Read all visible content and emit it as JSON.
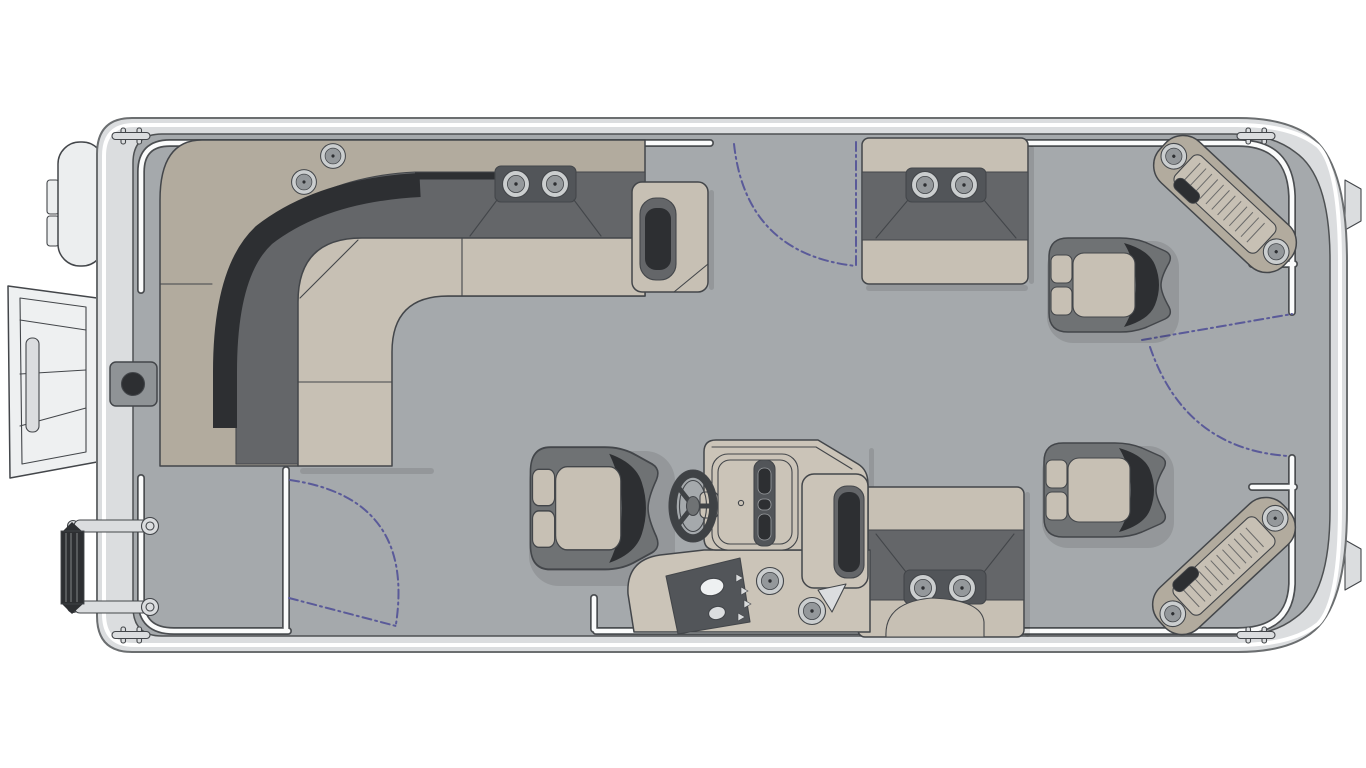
{
  "canvas": {
    "width": 1366,
    "height": 768,
    "background": "#ffffff"
  },
  "colors": {
    "line": "#43464a",
    "hull": "#dbdddf",
    "hull2": "#eceeef",
    "deck": "#a5a9ac",
    "raild": "#4b4e51",
    "railw": "#fafbfb",
    "taupe": "#b2ab9e",
    "beige": "#c7c0b4",
    "dark": "#646669",
    "black": "#2d2f32",
    "module": "#525559",
    "chair": "#6f7274",
    "console": "#cbc4b8",
    "ring": "#cbcecf",
    "cupin": "#94989b",
    "swing": "#5a5a99",
    "wheel": "#3f4245",
    "mount": "#8f9396",
    "bg": "#ffffff"
  },
  "floorplan": {
    "vessel": "pontoon-boat-deck-top-view",
    "orientation": "bow-right-stern-left",
    "zones": [
      {
        "name": "wraparound-lounge",
        "shape": "l-shaped",
        "cup_holders": 2,
        "deck_cup_holders": 2,
        "end_armrest": true
      },
      {
        "name": "forward-bench",
        "cup_holders": 2
      },
      {
        "name": "aft-bench",
        "cup_holders": 2
      },
      {
        "name": "companion-chairs",
        "count": 2
      },
      {
        "name": "helm-station",
        "steering_wheel": true,
        "gauge_slots": 3,
        "switch_buttons": 2,
        "cup_holders": 2,
        "captain_chair": true
      },
      {
        "name": "bow-corner-steps",
        "count": 2,
        "recessed_lights_each": 2
      },
      {
        "name": "gates",
        "count": 3,
        "swing_arcs_dashed": true
      },
      {
        "name": "stern-hardware",
        "outboard_motor_pod": true,
        "boarding_ramp_open": true,
        "swim_ladder": true,
        "table_mount": true
      },
      {
        "name": "cleats",
        "count": 4
      }
    ]
  }
}
